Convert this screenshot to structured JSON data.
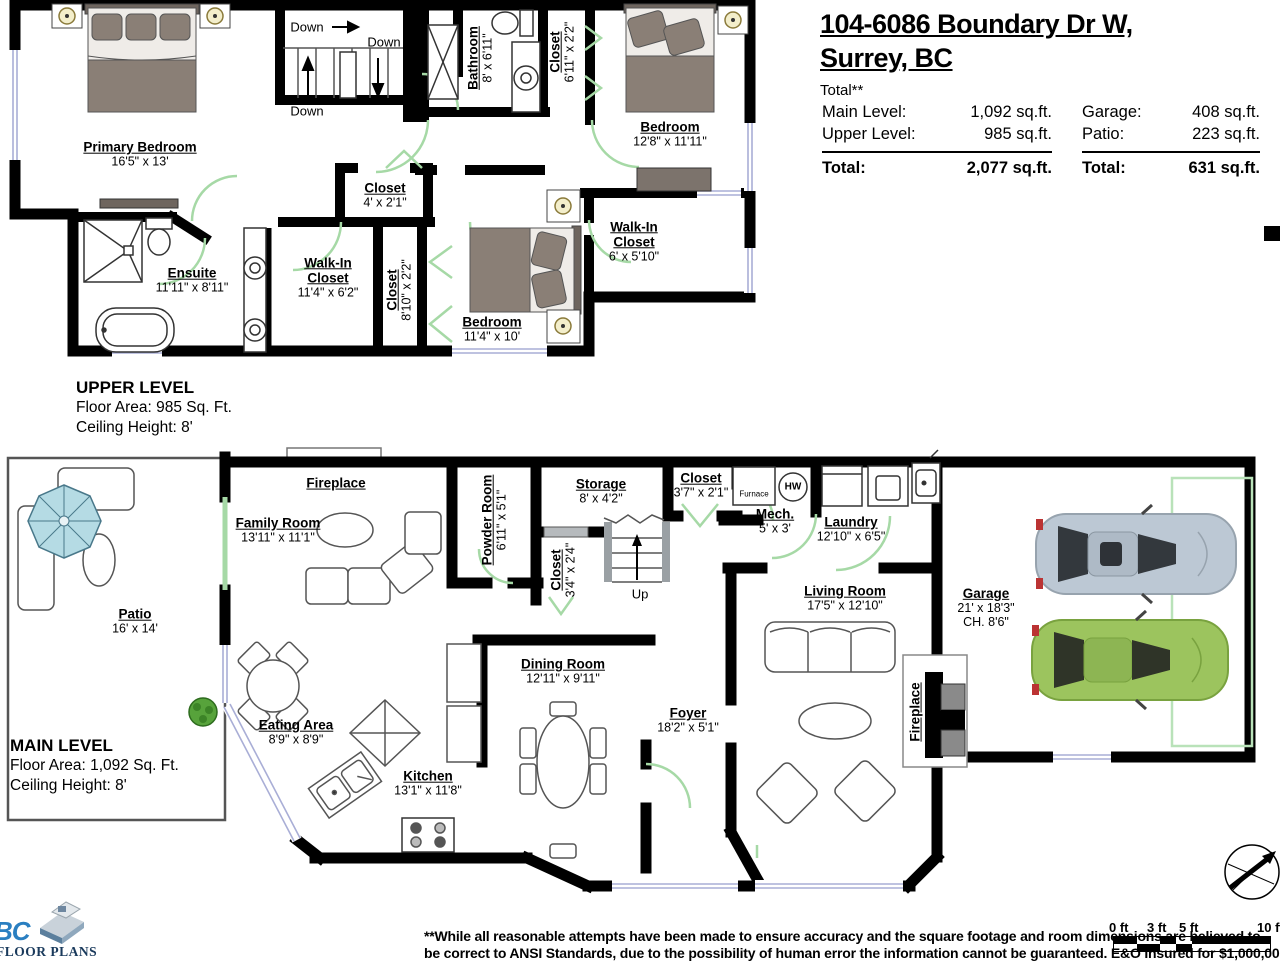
{
  "header": {
    "address_line1": "104-6086 Boundary Dr W,",
    "address_line2": "Surrey, BC",
    "total_note": "Total**",
    "left_rows": [
      {
        "label": "Main Level:",
        "value": "1,092 sq.ft."
      },
      {
        "label": "Upper Level:",
        "value": "985 sq.ft."
      }
    ],
    "left_total": {
      "label": "Total:",
      "value": "2,077 sq.ft."
    },
    "right_rows": [
      {
        "label": "Garage:",
        "value": "408 sq.ft."
      },
      {
        "label": "Patio:",
        "value": "223 sq.ft."
      }
    ],
    "right_total": {
      "label": "Total:",
      "value": "631 sq.ft."
    }
  },
  "upper": {
    "title": "UPPER LEVEL",
    "area": "Floor Area: 985 Sq. Ft.",
    "ceiling": "Ceiling Height: 8'",
    "stair_labels": [
      "Down",
      "Down",
      "Down"
    ],
    "rooms": {
      "primary_bedroom": {
        "name": "Primary Bedroom",
        "dims": "16'5\" x 13'"
      },
      "bathroom": {
        "name": "Bathroom",
        "dims": "8' x 6'11\""
      },
      "closet_top": {
        "name": "Closet",
        "dims": "6'11\" x 2'2\""
      },
      "bedroom_right": {
        "name": "Bedroom",
        "dims": "12'8\" x 11'11\""
      },
      "closet_hall": {
        "name": "Closet",
        "dims": "4' x 2'1\""
      },
      "ensuite": {
        "name": "Ensuite",
        "dims": "11'11\" x 8'11\""
      },
      "walkin_primary": {
        "name": "Walk-In Closet",
        "dims": "11'4\" x 6'2\""
      },
      "closet_mid": {
        "name": "Closet",
        "dims": "8'10\" x 2'2\""
      },
      "bedroom_bottom": {
        "name": "Bedroom",
        "dims": "11'4\" x 10'"
      },
      "walkin_right": {
        "name": "Walk-In Closet",
        "dims": "6' x 5'10\""
      }
    }
  },
  "main": {
    "title": "MAIN LEVEL",
    "area": "Floor Area: 1,092 Sq. Ft.",
    "ceiling": "Ceiling Height: 8'",
    "stair_label": "Up",
    "equipment": {
      "furnace": "Furnace",
      "hw": "HW"
    },
    "rooms": {
      "patio": {
        "name": "Patio",
        "dims": "16' x 14'"
      },
      "fireplace_family": {
        "name": "Fireplace"
      },
      "family_room": {
        "name": "Family Room",
        "dims": "13'11\" x 11'1\""
      },
      "powder_room": {
        "name": "Powder Room",
        "dims": "6'11\" x 5'1\""
      },
      "storage": {
        "name": "Storage",
        "dims": "8' x 4'2\""
      },
      "closet_small": {
        "name": "Closet",
        "dims": "3'4\" x 2'4\""
      },
      "closet_hall": {
        "name": "Closet",
        "dims": "3'7\" x 2'1\""
      },
      "mech": {
        "name": "Mech.",
        "dims": "5' x 3'"
      },
      "laundry": {
        "name": "Laundry",
        "dims": "12'10\" x 6'5\""
      },
      "living_room": {
        "name": "Living Room",
        "dims": "17'5\" x 12'10\""
      },
      "garage": {
        "name": "Garage",
        "dims": "21' x 18'3\"",
        "dims2": "CH. 8'6\""
      },
      "fireplace_living": {
        "name": "Fireplace"
      },
      "eating_area": {
        "name": "Eating Area",
        "dims": "8'9\" x 8'9\""
      },
      "kitchen": {
        "name": "Kitchen",
        "dims": "13'1\" x 11'8\""
      },
      "dining_room": {
        "name": "Dining Room",
        "dims": "12'11\" x 9'11\""
      },
      "foyer": {
        "name": "Foyer",
        "dims": "18'2\" x 5'1\""
      }
    }
  },
  "scale_bar": {
    "ticks": [
      "0 ft",
      "3 ft",
      "5 ft",
      "10 ft"
    ]
  },
  "compass": {
    "label": "N"
  },
  "logo": {
    "brand": "BC",
    "line": "FLOOR PLANS"
  },
  "disclaimer": {
    "line1": "**While all reasonable attempts have been made to ensure accuracy and the square footage and room dimensions are believed to",
    "line2": "be correct to ANSI Standards, due to the possibility of human error the information cannot be guaranteed. E&O Insured for $1,000,000."
  },
  "colors": {
    "wall": "#000000",
    "door_green": "#a6d9a6",
    "window_blue": "#a9aed6",
    "furniture_dark": "#8a7f76",
    "car_silver": "#bcc8d4",
    "car_green": "#9cc45e",
    "umbrella_blue": "#b5dbe4",
    "logo_blue": "#2a7fc1"
  }
}
